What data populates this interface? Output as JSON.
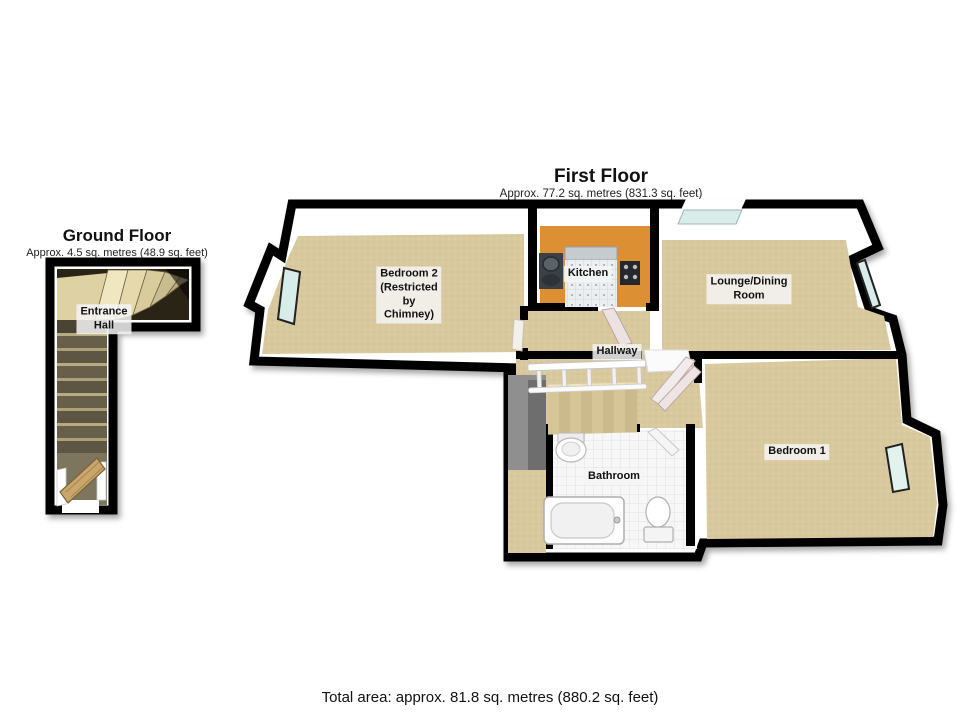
{
  "ground_floor": {
    "title": "Ground Floor",
    "subtitle": "Approx. 4.5 sq. metres (48.9 sq. feet)",
    "rooms": [
      {
        "name": "Entrance Hall",
        "label": "Entrance\nHall"
      }
    ],
    "fixtures": [
      "staircase-winder",
      "staircase-straight",
      "entrance-door"
    ]
  },
  "first_floor": {
    "title": "First Floor",
    "subtitle": "Approx. 77.2 sq. metres (831.3 sq. feet)",
    "rooms": [
      {
        "name": "Bedroom 2",
        "label": "Bedroom 2\n(Restricted\nby\nChimney)"
      },
      {
        "name": "Kitchen",
        "label": "Kitchen"
      },
      {
        "name": "Lounge/Dining Room",
        "label": "Lounge/Dining\nRoom"
      },
      {
        "name": "Hallway",
        "label": "Hallway"
      },
      {
        "name": "Bathroom",
        "label": "Bathroom"
      },
      {
        "name": "Bedroom 1",
        "label": "Bedroom 1"
      }
    ],
    "fixtures": [
      "kitchen-sink",
      "kitchen-hob",
      "staircase",
      "banister",
      "bathtub",
      "basin",
      "toilet",
      "doors",
      "windows"
    ]
  },
  "footer": {
    "total_area": "Total area: approx. 81.8 sq. metres (880.2 sq. feet)"
  },
  "palette": {
    "wall": "#000000",
    "carpet": "#d9c99e",
    "kitchen_floor": "#dd8f33",
    "bathroom_floor": "#f7f7f7",
    "window_glass": "#d8edea",
    "stair_void_grey": "#8f8f8f",
    "wood_door": "#c9a66b",
    "label_background": "#f2f2f2"
  }
}
